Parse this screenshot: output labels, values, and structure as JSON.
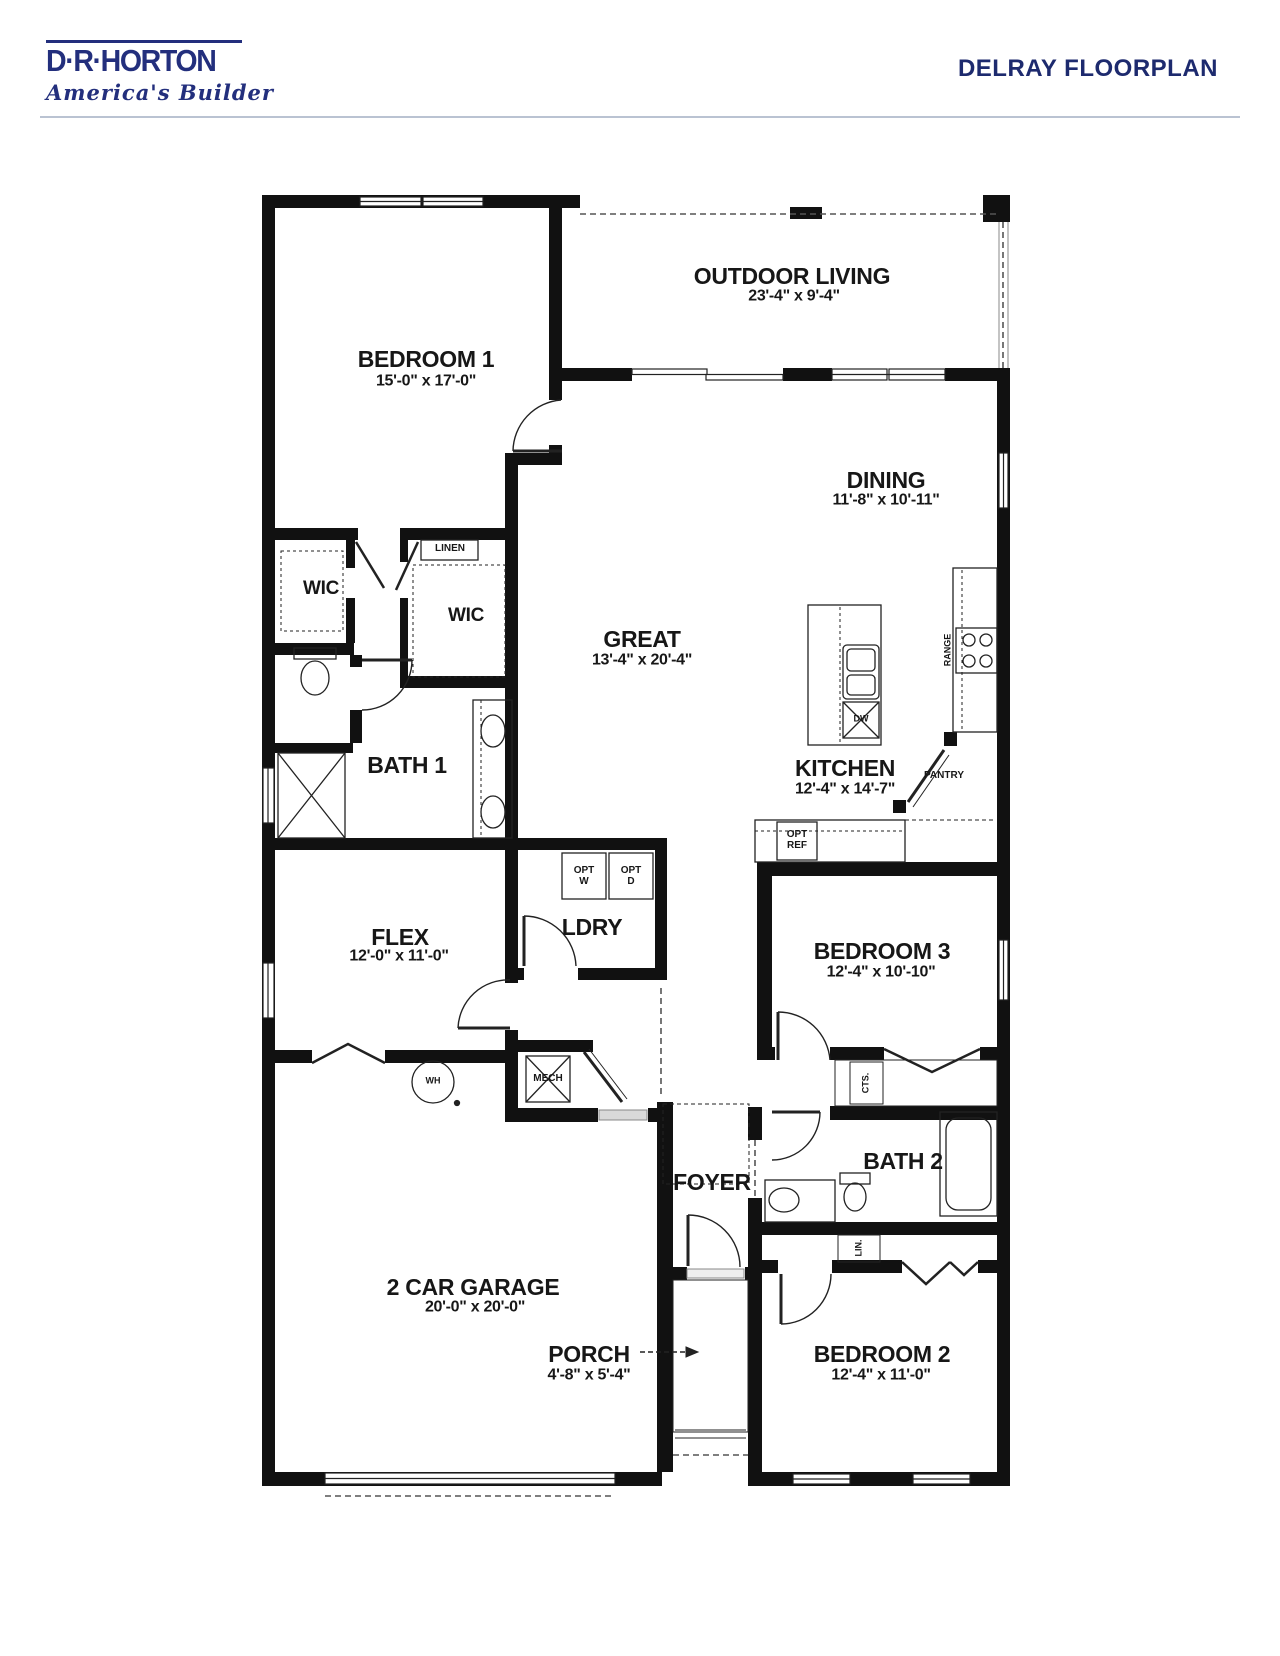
{
  "header": {
    "logo_name": "D·R·HORTON",
    "logo_reg": "®",
    "logo_tagline": "America's Builder",
    "title": "DELRAY FLOORPLAN"
  },
  "colors": {
    "brand_navy": "#232f7d",
    "title_navy": "#1d2a6e",
    "wall_black": "#111111",
    "divider_gray": "#bac3d2"
  },
  "rooms": {
    "bedroom1": {
      "name": "BEDROOM 1",
      "dims": "15'-0\" x 17'-0\""
    },
    "outdoor": {
      "name": "OUTDOOR LIVING",
      "dims": "23'-4\" x 9'-4\""
    },
    "dining": {
      "name": "DINING",
      "dims": "11'-8\" x 10'-11\""
    },
    "great": {
      "name": "GREAT",
      "dims": "13'-4\" x 20'-4\""
    },
    "kitchen": {
      "name": "KITCHEN",
      "dims": "12'-4\" x 14'-7\""
    },
    "flex": {
      "name": "FLEX",
      "dims": "12'-0\" x 11'-0\""
    },
    "bedroom3": {
      "name": "BEDROOM 3",
      "dims": "12'-4\" x 10'-10\""
    },
    "garage": {
      "name": "2 CAR GARAGE",
      "dims": "20'-0\" x 20'-0\""
    },
    "porch": {
      "name": "PORCH",
      "dims": "4'-8\" x 5'-4\""
    },
    "bedroom2": {
      "name": "BEDROOM 2",
      "dims": "12'-4\" x 11'-0\""
    }
  },
  "labels": {
    "wic1": "WIC",
    "wic2": "WIC",
    "bath1": "BATH 1",
    "ldry": "LDRY",
    "foyer": "FOYER",
    "bath2": "BATH 2",
    "linen": "LINEN",
    "mech": "MECH",
    "wh": "WH",
    "dw": "DW",
    "range": "RANGE",
    "pantry": "PANTRY",
    "cts": "CTS.",
    "lin": "LIN.",
    "opt_w_1": "OPT",
    "opt_w_2": "W",
    "opt_d_1": "OPT",
    "opt_d_2": "D",
    "opt_ref_1": "OPT",
    "opt_ref_2": "REF"
  }
}
